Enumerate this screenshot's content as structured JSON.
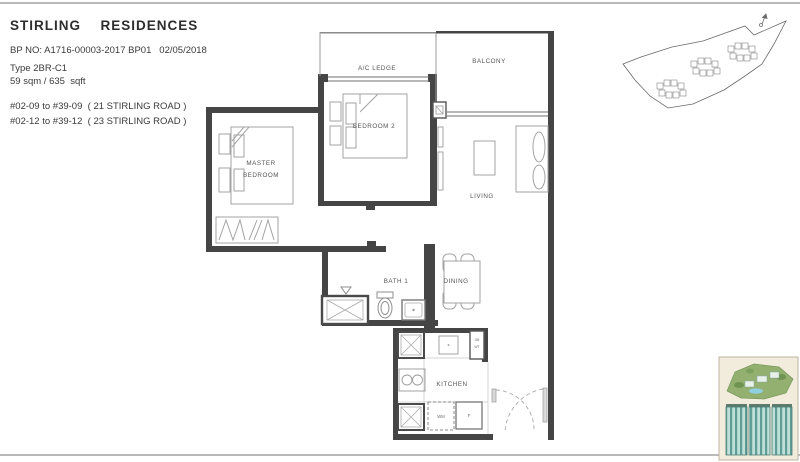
{
  "header": {
    "title": "STIRLING  RESIDENCES",
    "bp_line": "BP NO: A1716-00003-2017 BP01   02/05/2018",
    "unit_type": "Type 2BR-C1",
    "area": "59 sqm / 635  sqft",
    "stack_line1": "#02-09 to #39-09  ( 21 STIRLING ROAD )",
    "stack_line2": "#02-12 to #39-12  ( 23 STIRLING ROAD )"
  },
  "floorplan": {
    "rooms": {
      "ac_ledge": "A/C LEDGE",
      "balcony": "BALCONY",
      "bedroom2": "BEDROOM 2",
      "master_line1": "MASTER",
      "master_line2": "BEDROOM",
      "living": "LIVING",
      "bath": "BATH 1",
      "dining": "DINING",
      "kitchen": "KITCHEN"
    },
    "appliances": {
      "washing_machine": "WM",
      "fridge": "F",
      "db": "DB",
      "wt": "WT"
    }
  },
  "colors": {
    "wall": "#454545",
    "furniture": "#a3a3a3",
    "label_text": "#565656",
    "page_rule": "#b9b9b9",
    "thumb_card_bg": "#f2ecdd",
    "thumb_green": "#93b071",
    "thumb_teal": "#5f9e96",
    "thumb_pool_blue": "#8fd0e0"
  }
}
